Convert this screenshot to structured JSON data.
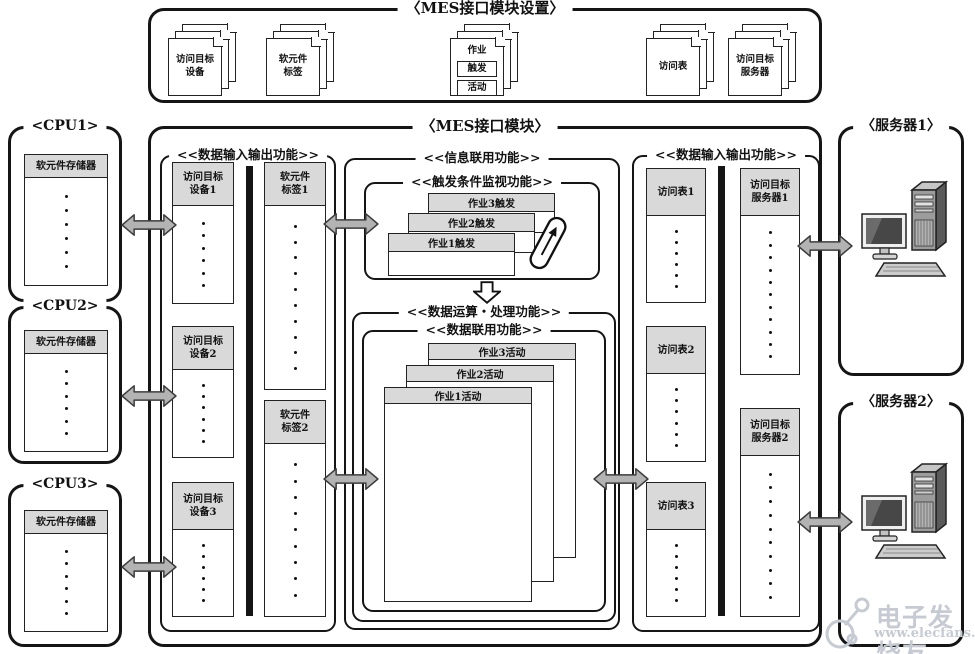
{
  "colors": {
    "border": "#151515",
    "panel_header_fill": "#d9d9d9",
    "arrow_fill": "#b3b3b3",
    "watermark": "#c6cad3"
  },
  "settings_box": {
    "title": "〈MES接口模块设置〉",
    "docs": [
      {
        "label": "访问目标\n设备"
      },
      {
        "label": "软元件\n标签"
      },
      {
        "label": "作业",
        "sub": [
          "触发",
          "活动"
        ]
      },
      {
        "label": "访问表"
      },
      {
        "label": "访问目标\n服务器"
      }
    ]
  },
  "cpus": [
    {
      "title": "<CPU1>",
      "memory_label": "软元件存储器",
      "dots": 6
    },
    {
      "title": "<CPU2>",
      "memory_label": "软元件存储器",
      "dots": 6
    },
    {
      "title": "<CPU3>",
      "memory_label": "软元件存储器",
      "dots": 6
    }
  ],
  "mes": {
    "title": "〈MES接口模块〉",
    "left_io": {
      "title": "<<数据输入输出功能>>",
      "devices": [
        {
          "label": "访问目标\n设备1",
          "dots": 6
        },
        {
          "label": "访问目标\n设备2",
          "dots": 6
        },
        {
          "label": "访问目标\n设备3",
          "dots": 6
        }
      ],
      "tags": [
        {
          "label": "软元件\n标签1",
          "dots": 10
        },
        {
          "label": "软元件\n标签2",
          "dots": 9
        }
      ]
    },
    "info_link": {
      "title": "<<信息联用功能>>",
      "trigger_monitor": {
        "title": "<<触发条件监视功能>>",
        "jobs": [
          "作业3触发",
          "作业2触发",
          "作业1触发"
        ]
      },
      "processing": {
        "title": "<<数据运算・处理功能>>",
        "data_link": {
          "title": "<<数据联用功能>>",
          "jobs": [
            "作业3活动",
            "作业2活动",
            "作业1活动"
          ]
        }
      }
    },
    "right_io": {
      "title": "<<数据输入输出功能>>",
      "tables": [
        {
          "label": "访问表1",
          "dots": 6
        },
        {
          "label": "访问表2",
          "dots": 6
        },
        {
          "label": "访问表3",
          "dots": 6
        }
      ],
      "servers": [
        {
          "label": "访问目标\n服务器1",
          "dots": 11
        },
        {
          "label": "访问目标\n服务器2",
          "dots": 10
        }
      ]
    }
  },
  "servers": [
    {
      "title": "〈服务器1〉"
    },
    {
      "title": "〈服务器2〉"
    }
  ],
  "watermark": {
    "name": "电子发烧友",
    "url": "www.elecfans.com"
  }
}
